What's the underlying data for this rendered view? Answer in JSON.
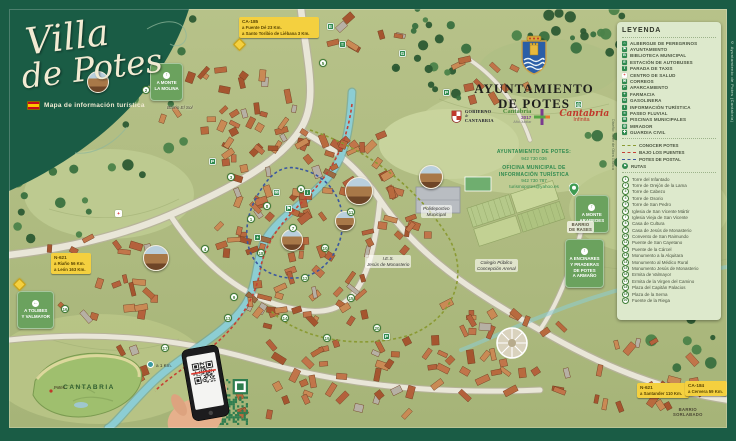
{
  "title": {
    "line1": "Villa",
    "line2": "de Potes",
    "subtitle": "Mapa de información turística"
  },
  "municipality": {
    "name_line1": "AYUNTAMIENTO",
    "name_line2": "DE POTES"
  },
  "logos": {
    "gobierno": {
      "l1": "GOBIERNO",
      "l2": "de",
      "l3": "CANTABRIA"
    },
    "jubilar": {
      "l1": "Cantabria",
      "l2": "2017",
      "l3": "Año Jubilar"
    },
    "infinita": {
      "l1": "Cantabria",
      "l2": "Infinita"
    }
  },
  "contact": {
    "town_hall_label": "AYUNTAMIENTO DE POTES:",
    "town_hall_phone": "942 730 036",
    "office_line1": "OFICINA MUNICIPAL DE",
    "office_line2": "INFORMACIÓN TURÍSTICA",
    "office_phone": "942 730 787",
    "office_email": "turismopotes@yahoo.es"
  },
  "legend": {
    "title": "LEYENDA",
    "services": [
      {
        "glyph": "⌂",
        "label": "ALBERGUE DE PEREGRINOS",
        "bg": "#2f8a4f",
        "fg": "#ffffff"
      },
      {
        "glyph": "⚑",
        "label": "AYUNTAMIENTO",
        "bg": "#2f8a4f",
        "fg": "#ffffff"
      },
      {
        "glyph": "B",
        "label": "BIBLIOTECA MUNICIPAL",
        "bg": "#2f8a4f",
        "fg": "#ffffff"
      },
      {
        "glyph": "E",
        "label": "ESTACIÓN DE AUTOBUSES",
        "bg": "#2f8a4f",
        "fg": "#ffffff"
      },
      {
        "glyph": "T",
        "label": "PARADA DE TAXIS",
        "bg": "#2f8a4f",
        "fg": "#ffffff"
      },
      {
        "glyph": "+",
        "label": "CENTRO DE SALUD",
        "bg": "#ffffff",
        "fg": "#d42222"
      },
      {
        "glyph": "✉",
        "label": "CORREOS",
        "bg": "#2f8a4f",
        "fg": "#ffffff"
      },
      {
        "glyph": "P",
        "label": "APARCAMIENTO",
        "bg": "#2f8a4f",
        "fg": "#ffffff"
      },
      {
        "glyph": "+",
        "label": "FARMACIA",
        "bg": "#2f8a4f",
        "fg": "#ffffff"
      },
      {
        "glyph": "G",
        "label": "GASOLINERA",
        "bg": "#2f8a4f",
        "fg": "#ffffff"
      },
      {
        "glyph": "i",
        "label": "INFORMACIÓN TURÍSTICA",
        "bg": "#2f8a4f",
        "fg": "#ffffff"
      },
      {
        "glyph": "≈",
        "label": "PASEO FLUVIAL",
        "bg": "#2f8a4f",
        "fg": "#ffffff"
      },
      {
        "glyph": "≋",
        "label": "PISCINAS MUNICIPALES",
        "bg": "#2f8a4f",
        "fg": "#ffffff"
      },
      {
        "glyph": "◎",
        "label": "MIRADOR",
        "bg": "#2f8a4f",
        "fg": "#ffffff"
      },
      {
        "glyph": "✚",
        "label": "GUARDIA CIVIL",
        "bg": "#2f8a4f",
        "fg": "#ffffff"
      }
    ],
    "routes": [
      {
        "label": "CONOCER POTES",
        "color": "#8a9a33"
      },
      {
        "label": "BAJO LOS PUENTES",
        "color": "#c54134"
      },
      {
        "label": "POTES DE POSTAL",
        "color": "#3a57a0"
      }
    ],
    "rutas_label": "RUTAS",
    "rutas_glyph": "⚑",
    "landmarks": [
      {
        "num": "1",
        "name": "Torre del Infantado"
      },
      {
        "num": "2",
        "name": "Torre de Orejón de la Lama"
      },
      {
        "num": "3",
        "name": "Torre de Cabezo"
      },
      {
        "num": "4",
        "name": "Torre de Osorio"
      },
      {
        "num": "5",
        "name": "Torre de San Pedro"
      },
      {
        "num": "6",
        "name": "Iglesia de San Vicente Mártir"
      },
      {
        "num": "7",
        "name": "Iglesia Vieja de San Vicente"
      },
      {
        "num": "8",
        "name": "Casa de Cultura"
      },
      {
        "num": "9",
        "name": "Casa de Jesús de Monasterio"
      },
      {
        "num": "10",
        "name": "Convento de San Raimundo"
      },
      {
        "num": "11",
        "name": "Puente de San Cayetano"
      },
      {
        "num": "12",
        "name": "Puente de la Cárcel"
      },
      {
        "num": "13",
        "name": "Monumento a la Alquitara"
      },
      {
        "num": "14",
        "name": "Monumento al Médico Rural"
      },
      {
        "num": "15",
        "name": "Monumento Jesús de Monasterio"
      },
      {
        "num": "16",
        "name": "Ermita de Valmayor"
      },
      {
        "num": "17",
        "name": "Ermita de la Virgen del Camino"
      },
      {
        "num": "18",
        "name": "Plaza del Capitán Palacios"
      },
      {
        "num": "19",
        "name": "Plaza de la Serna"
      },
      {
        "num": "20",
        "name": "Fuente de la Riega"
      }
    ]
  },
  "road_signs": [
    {
      "text": "CA-185\na Fuente Dé 23 Km.\na Santo Toribio de Liébana 3 Km.",
      "x": 230,
      "y": 8
    },
    {
      "text": "N-621\na Riaño 56 Km.\na León 163 Km.",
      "x": 42,
      "y": 244
    },
    {
      "text": "N-621\na Santander 110 Km.",
      "x": 628,
      "y": 374
    },
    {
      "text": "CA-184\na Cervera 59 Km.",
      "x": 676,
      "y": 372
    }
  ],
  "badges": [
    {
      "arrow": "↑",
      "text": "A MONTE\nLA MOLINA",
      "x": 141,
      "y": 54
    },
    {
      "arrow": "↑",
      "text": "A MONTE\nARABEDES",
      "x": 566,
      "y": 186
    },
    {
      "arrow": "↑",
      "text": "A ENCINARES\nY PRADERAS\nDE POTES\nA ARMAÑO",
      "x": 556,
      "y": 230
    },
    {
      "arrow": "←",
      "text": "A TOLIBES\nY VALMAYOR",
      "x": 8,
      "y": 282
    }
  ],
  "map_labels": [
    {
      "text": "Barrio El Sol",
      "x": 158,
      "y": 96,
      "variant": "plain"
    },
    {
      "text": "BARRIO\nDE RASES",
      "x": 558,
      "y": 212,
      "variant": "tag"
    },
    {
      "text": "BARRIO\nSORLABADO",
      "x": 664,
      "y": 398,
      "variant": "dark"
    },
    {
      "text": "I.E.S.\nJesús de Monasterio",
      "x": 356,
      "y": 246,
      "variant": "pill"
    },
    {
      "text": "Colegio Público\nConcepción Arenal",
      "x": 466,
      "y": 250,
      "variant": "pill"
    },
    {
      "text": "Polideportivo\nMunicipal",
      "x": 412,
      "y": 196,
      "variant": "pill"
    },
    {
      "text": "a 1 Km.",
      "x": 138,
      "y": 352,
      "variant": "dot"
    }
  ],
  "map_markers": [
    {
      "num": "1",
      "x": 238,
      "y": 206
    },
    {
      "num": "2",
      "x": 133,
      "y": 77
    },
    {
      "num": "3",
      "x": 218,
      "y": 164
    },
    {
      "num": "4",
      "x": 192,
      "y": 236
    },
    {
      "num": "5",
      "x": 310,
      "y": 50
    },
    {
      "num": "6",
      "x": 288,
      "y": 176
    },
    {
      "num": "7",
      "x": 280,
      "y": 215
    },
    {
      "num": "8",
      "x": 254,
      "y": 193
    },
    {
      "num": "9",
      "x": 221,
      "y": 284
    },
    {
      "num": "10",
      "x": 312,
      "y": 235
    },
    {
      "num": "11",
      "x": 338,
      "y": 199
    },
    {
      "num": "12",
      "x": 292,
      "y": 265
    },
    {
      "num": "13",
      "x": 215,
      "y": 305
    },
    {
      "num": "14",
      "x": 272,
      "y": 305
    },
    {
      "num": "15",
      "x": 338,
      "y": 285
    },
    {
      "num": "16",
      "x": 52,
      "y": 296
    },
    {
      "num": "17",
      "x": 152,
      "y": 335
    },
    {
      "num": "18",
      "x": 248,
      "y": 240
    },
    {
      "num": "19",
      "x": 314,
      "y": 325
    },
    {
      "num": "20",
      "x": 364,
      "y": 315
    }
  ],
  "map_icons": [
    {
      "glyph": "i",
      "x": 295,
      "y": 180,
      "bg": "#2f8a4f",
      "fg": "#ffffff"
    },
    {
      "glyph": "P",
      "x": 200,
      "y": 149,
      "bg": "#2f8a4f",
      "fg": "#ffffff"
    },
    {
      "glyph": "P",
      "x": 434,
      "y": 80,
      "bg": "#2f8a4f",
      "fg": "#ffffff"
    },
    {
      "glyph": "P",
      "x": 374,
      "y": 324,
      "bg": "#2f8a4f",
      "fg": "#ffffff"
    },
    {
      "glyph": "+",
      "x": 245,
      "y": 225,
      "bg": "#2f8a4f",
      "fg": "#ffffff"
    },
    {
      "glyph": "+",
      "x": 106,
      "y": 201,
      "bg": "#ffffff",
      "fg": "#d42222"
    },
    {
      "glyph": "E",
      "x": 318,
      "y": 14,
      "bg": "#2f8a4f",
      "fg": "#ffffff"
    },
    {
      "glyph": "G",
      "x": 390,
      "y": 41,
      "bg": "#2f8a4f",
      "fg": "#ffffff"
    },
    {
      "glyph": "≈",
      "x": 330,
      "y": 32,
      "bg": "#2f8a4f",
      "fg": "#ffffff"
    },
    {
      "glyph": "◎",
      "x": 566,
      "y": 92,
      "bg": "#2f8a4f",
      "fg": "#ffffff"
    },
    {
      "glyph": "✉",
      "x": 264,
      "y": 180,
      "bg": "#2f8a4f",
      "fg": "#ffffff"
    },
    {
      "glyph": "⚑",
      "x": 276,
      "y": 196,
      "bg": "#2f8a4f",
      "fg": "#ffffff"
    }
  ],
  "inset": {
    "region": "CANTABRIA",
    "town": "Potes"
  },
  "qr_caption": "Descargar\nmapa",
  "credits": {
    "right": "© Ayuntamiento de Potes (Cantabria)",
    "left": "Diseño: Taller de Obra Gráfica"
  }
}
